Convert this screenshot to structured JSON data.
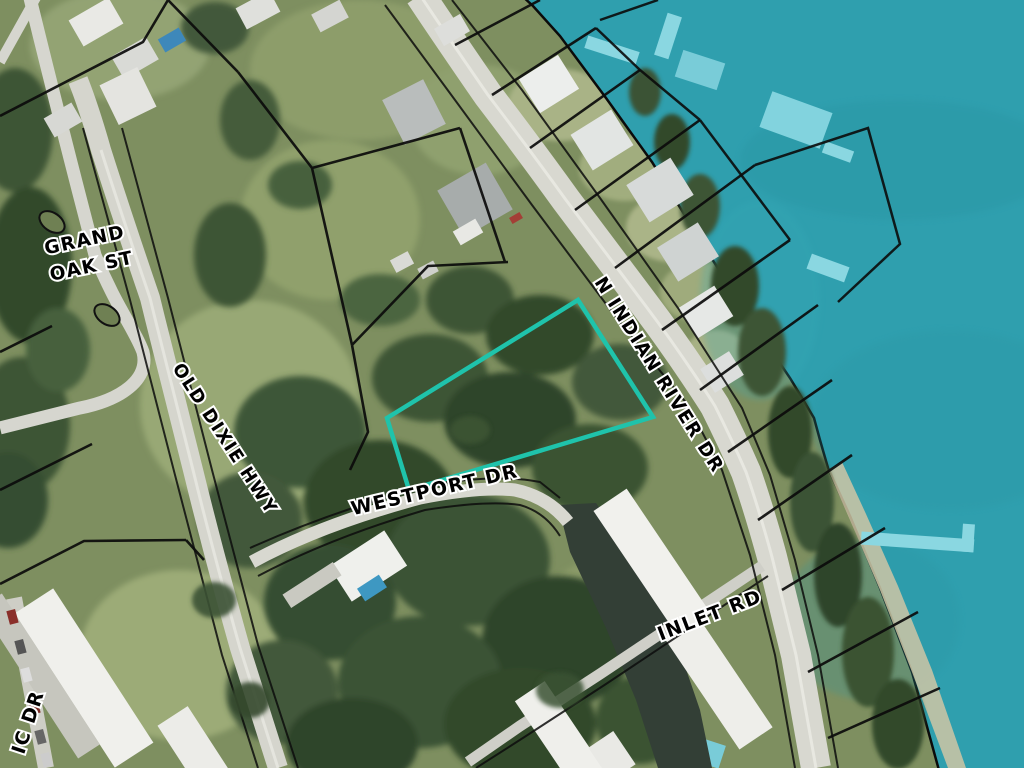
{
  "map": {
    "description": "Aerial parcel map with highlighted lot",
    "labels": [
      {
        "id": "grand-oak-line1",
        "text": "GRAND"
      },
      {
        "id": "grand-oak-line2",
        "text": "OAK ST"
      },
      {
        "id": "old-dixie",
        "text": "OLD DIXIE HWY"
      },
      {
        "id": "n-indian-river",
        "text": "N INDIAN RIVER DR"
      },
      {
        "id": "westport",
        "text": "WESTPORT DR"
      },
      {
        "id": "inlet",
        "text": "INLET RD"
      },
      {
        "id": "partial-drive",
        "text": "IC DR"
      }
    ],
    "highlighted_parcel": {
      "shape": "quadrilateral",
      "outline_color": "#1fc3ab"
    },
    "colors": {
      "water": "#2f9fae",
      "dock": "#8ad7e1",
      "parcel_line": "#0b0b0b",
      "label_text": "#000000",
      "label_halo": "#ffffff",
      "road": "#d8d8d0",
      "canal": "#333f36"
    }
  }
}
